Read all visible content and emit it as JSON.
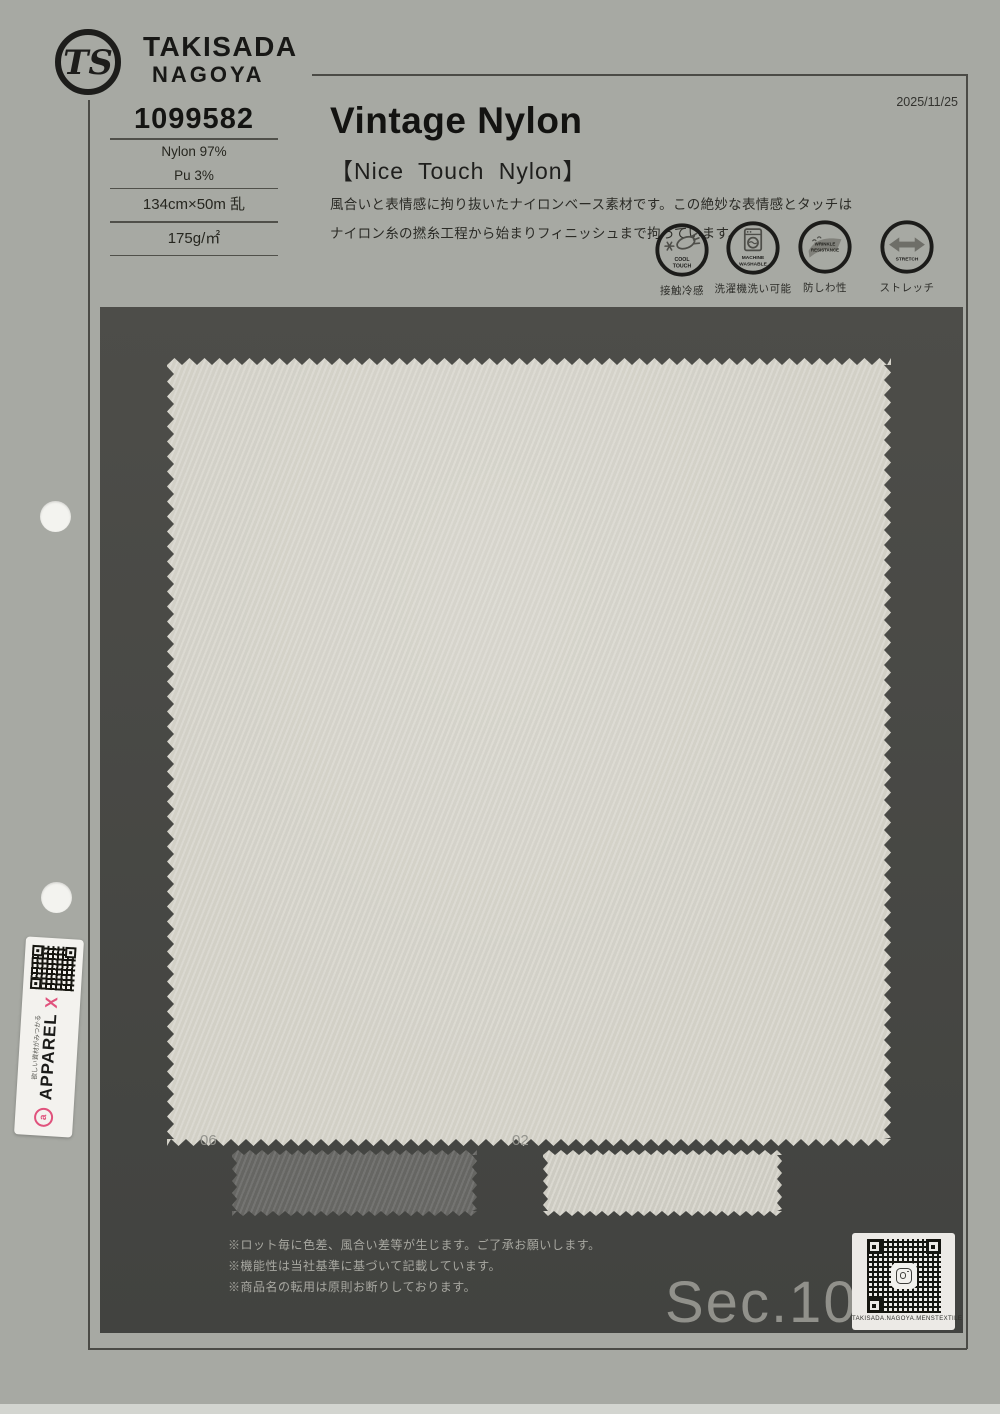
{
  "document": {
    "date": "2025/11/25"
  },
  "brand": {
    "logo": "TS",
    "name_top": "TAKISADA",
    "name_bottom": "NAGOYA"
  },
  "product": {
    "number": "1099582",
    "composition_1": "Nylon 97%",
    "composition_2": "Pu 3%",
    "width_length": "134cm×50m 乱",
    "weight": "175g/㎡",
    "title": "Vintage Nylon",
    "subtitle": "【Nice Touch Nylon】",
    "description_1": "風合いと表情感に拘り抜いたナイロンベース素材です。この絶妙な表情感とタッチは",
    "description_2": "ナイロン糸の撚糸工程から始まりフィニッシュまで拘っています。"
  },
  "features": [
    {
      "name": "cool-touch",
      "label_en_1": "COOL",
      "label_en_2": "TOUCH",
      "label_jp": "接触冷感"
    },
    {
      "name": "machine-washable",
      "label_en_1": "MACHINE",
      "label_en_2": "WASHABLE",
      "label_jp": "洗濯機洗い可能"
    },
    {
      "name": "wrinkle-resistance",
      "label_en_1": "WRINKLE",
      "label_en_2": "RESISTANCE",
      "label_jp": "防しわ性"
    },
    {
      "name": "stretch",
      "label_en_1": "STRETCH",
      "label_en_2": "",
      "label_jp": "ストレッチ"
    }
  ],
  "swatch": {
    "main_color": "#d9d7ce",
    "samples": [
      {
        "code": "06",
        "color": "#6a6a67"
      },
      {
        "code": "02",
        "color": "#d7d5cc"
      }
    ]
  },
  "notes": {
    "line_1": "※ロット毎に色差、風合い差等が生じます。ご了承お願いします。",
    "line_2": "※機能性は当社基準に基づいて記載しています。",
    "line_3": "※商品名の転用は原則お断りしております。"
  },
  "footer": {
    "section": "Sec.10",
    "qr_caption": "TAKISADA.NAGOYA.MENSTEXTILE"
  },
  "sticker": {
    "brand": "APPAREL",
    "brand_x": "X",
    "tagline": "欲しい資材がみつかる",
    "x_color": "#e0527c"
  }
}
